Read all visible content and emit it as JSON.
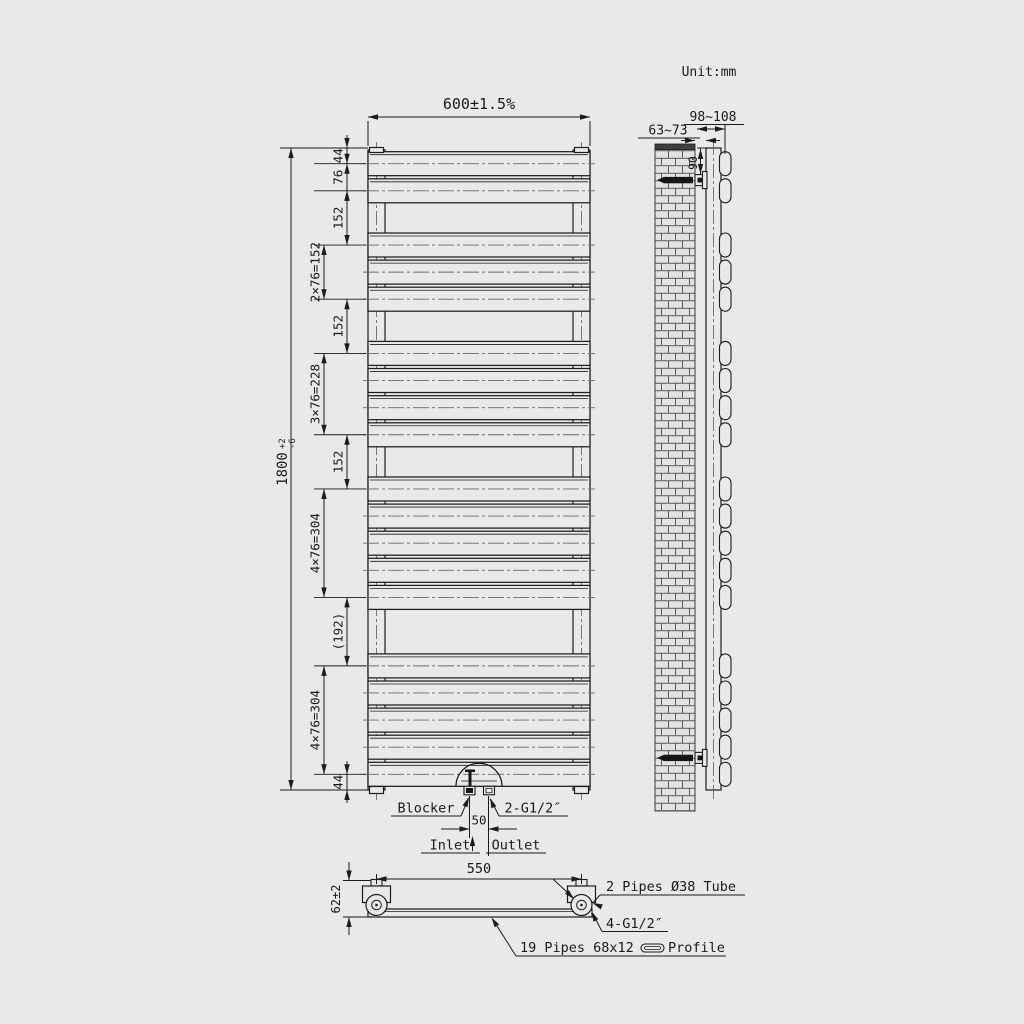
{
  "title": {
    "unit": "Unit:mm"
  },
  "front_view": {
    "width_dim": "600±1.5%",
    "height_dim": {
      "value": "1800",
      "tol_plus": "+2",
      "tol_minus": "-6"
    },
    "pipe_centers_mm": [
      44,
      120,
      272,
      348,
      424,
      576,
      652,
      728,
      804,
      956,
      1032,
      1108,
      1184,
      1260,
      1452,
      1528,
      1604,
      1680,
      1756
    ],
    "total_height_mm": 1800,
    "segment_dims": [
      {
        "label": "44",
        "from": 0,
        "to": 44,
        "col": "inner"
      },
      {
        "label": "76",
        "from": 44,
        "to": 120,
        "col": "inner"
      },
      {
        "label": "152",
        "from": 120,
        "to": 272,
        "col": "inner"
      },
      {
        "label": "2×76=152",
        "from": 272,
        "to": 424,
        "col": "outer"
      },
      {
        "label": "152",
        "from": 424,
        "to": 576,
        "col": "inner"
      },
      {
        "label": "3×76=228",
        "from": 576,
        "to": 804,
        "col": "outer"
      },
      {
        "label": "152",
        "from": 804,
        "to": 956,
        "col": "inner"
      },
      {
        "label": "4×76=304",
        "from": 956,
        "to": 1260,
        "col": "outer"
      },
      {
        "label": "(192)",
        "from": 1260,
        "to": 1452,
        "col": "inner"
      },
      {
        "label": "4×76=304",
        "from": 1452,
        "to": 1756,
        "col": "outer"
      },
      {
        "label": "44",
        "from": 1756,
        "to": 1800,
        "col": "inner"
      }
    ],
    "bottom_detail": {
      "blocker": "Blocker",
      "connection": "2-G1/2″",
      "spacing": "50",
      "inlet": "Inlet",
      "outlet": "Outlet"
    }
  },
  "side_view": {
    "wall_gap": "63~73",
    "depth": "98~108",
    "bracket_offset": "90",
    "bracket_positions_mm": [
      90,
      1710
    ]
  },
  "bottom_view": {
    "tube_spacing": "550",
    "height": "62±2",
    "tubes_label": "2 Pipes Ø38 Tube",
    "threads_label": "4-G1/2″",
    "profile_label_prefix": "19 Pipes 68x12",
    "profile_label_suffix": "Profile"
  },
  "colors": {
    "background": "#e9e9e9",
    "line": "#1c1c1c",
    "centerline": "#6a6a6a",
    "fill_dark": "#161616",
    "wall_cap": "#3f3f3f",
    "brick_line": "#4a4a4a"
  }
}
